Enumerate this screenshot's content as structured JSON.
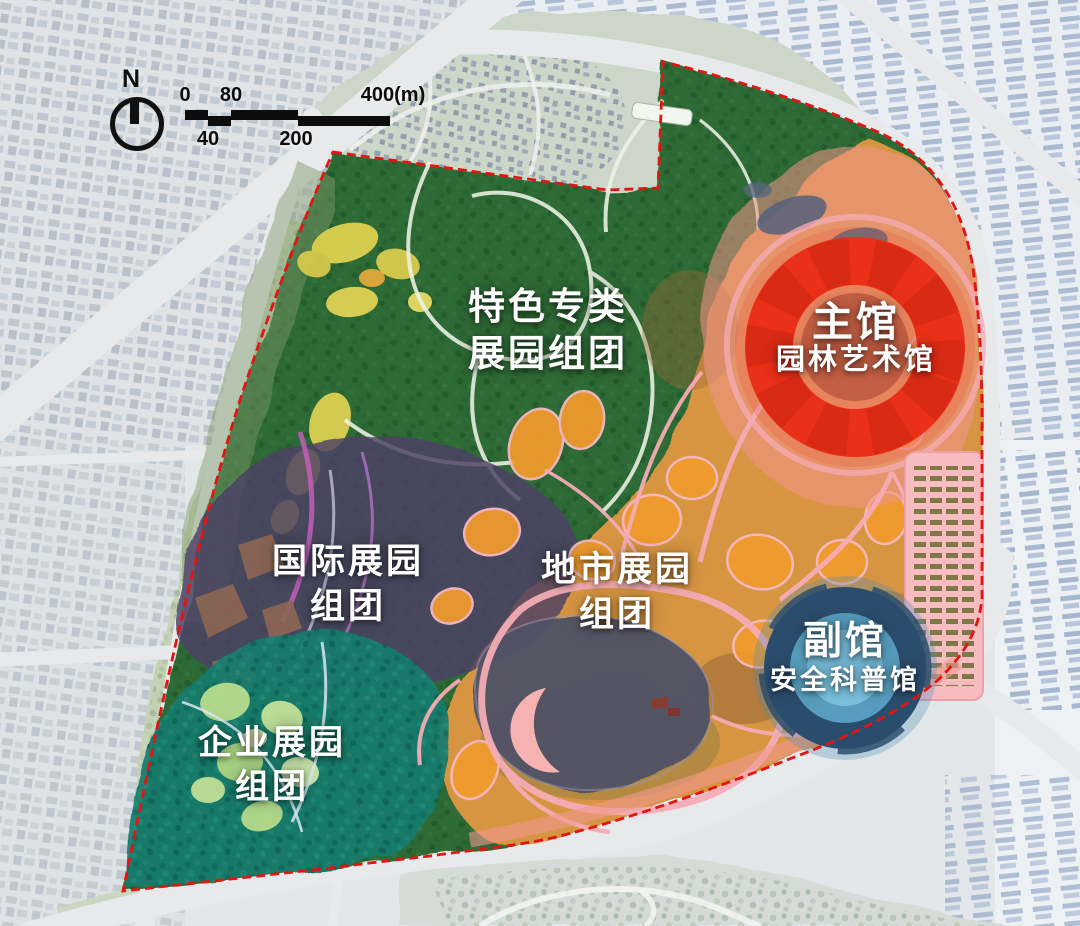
{
  "compass": {
    "label": "N"
  },
  "scalebar": {
    "t0": "0",
    "t40": "40",
    "t80": "80",
    "t200": "200",
    "t400": "400(m)"
  },
  "zones": {
    "featured": {
      "line1": "特色专类",
      "line2": "展园组团",
      "color": "#2e6b34"
    },
    "international": {
      "line1": "国际展园",
      "line2": "组团",
      "color": "#4e4066"
    },
    "enterprise": {
      "line1": "企业展园",
      "line2": "组团",
      "color": "#177c6e"
    },
    "city": {
      "line1": "地市展园",
      "line2": "组团",
      "color": "#d79542"
    },
    "main_hall": {
      "line1": "主馆",
      "line2": "园林艺术馆",
      "color": "#ea3018"
    },
    "aux_hall": {
      "line1": "副馆",
      "line2": "安全科普馆",
      "color": "#2b4d6d"
    }
  }
}
